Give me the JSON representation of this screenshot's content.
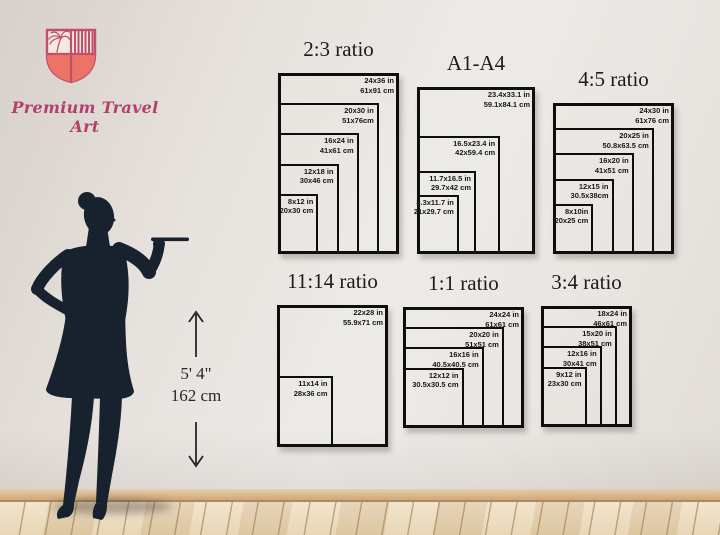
{
  "brand": {
    "name": "Premium Travel Art",
    "logo_icon": "shield-palm-logo-icon",
    "colors": {
      "logo_outline": "#c24f6b",
      "logo_fill": "#ed7366",
      "logo_cream": "#f2eade",
      "text_pink": "#b1406a"
    }
  },
  "figure": {
    "description": "woman-silhouette-scale-reference",
    "height_ft": "5' 4\"",
    "height_cm": "162 cm",
    "silhouette_color": "#18212e"
  },
  "scene": {
    "wall_color": "#e9e5e1",
    "baseboard_color": "#d4af82",
    "floor_color": "#e9d8bb",
    "line_color": "#0e0e0e"
  },
  "chart_data": [
    {
      "type": "nested-size-diagram",
      "title": "2:3 ratio",
      "sizes": [
        {
          "in": "24x36 in",
          "cm": "61x91 cm",
          "w": 24,
          "h": 36
        },
        {
          "in": "20x30 in",
          "cm": "51x76cm",
          "w": 20,
          "h": 30
        },
        {
          "in": "16x24 in",
          "cm": "41x61 cm",
          "w": 16,
          "h": 24
        },
        {
          "in": "12x18 in",
          "cm": "30x46 cm",
          "w": 12,
          "h": 18
        },
        {
          "in": "8x12 in",
          "cm": "20x30 cm",
          "w": 8,
          "h": 12
        }
      ]
    },
    {
      "type": "nested-size-diagram",
      "title": "A1-A4",
      "sizes": [
        {
          "in": "23.4x33.1 in",
          "cm": "59.1x84.1 cm",
          "w": 23.4,
          "h": 33.1
        },
        {
          "in": "16.5x23.4 in",
          "cm": "42x59.4 cm",
          "w": 16.5,
          "h": 23.4
        },
        {
          "in": "11.7x16.5 in",
          "cm": "29.7x42 cm",
          "w": 11.7,
          "h": 16.5
        },
        {
          "in": "8.3x11.7 in",
          "cm": "21x29.7 cm",
          "w": 8.3,
          "h": 11.7
        }
      ]
    },
    {
      "type": "nested-size-diagram",
      "title": "4:5 ratio",
      "sizes": [
        {
          "in": "24x30 in",
          "cm": "61x76 cm",
          "w": 24,
          "h": 30
        },
        {
          "in": "20x25 in",
          "cm": "50.8x63.5 cm",
          "w": 20,
          "h": 25
        },
        {
          "in": "16x20 in",
          "cm": "41x51 cm",
          "w": 16,
          "h": 20
        },
        {
          "in": "12x15 in",
          "cm": "30.5x38cm",
          "w": 12,
          "h": 15
        },
        {
          "in": "8x10in",
          "cm": "20x25 cm",
          "w": 8,
          "h": 10
        }
      ]
    },
    {
      "type": "nested-size-diagram",
      "title": "11:14 ratio",
      "sizes": [
        {
          "in": "22x28 in",
          "cm": "55.9x71 cm",
          "w": 22,
          "h": 28
        },
        {
          "in": "11x14 in",
          "cm": "28x36 cm",
          "w": 11,
          "h": 14
        }
      ]
    },
    {
      "type": "nested-size-diagram",
      "title": "1:1 ratio",
      "sizes": [
        {
          "in": "24x24 in",
          "cm": "61x61 cm",
          "w": 24,
          "h": 24
        },
        {
          "in": "20x20 in",
          "cm": "51x51 cm",
          "w": 20,
          "h": 20
        },
        {
          "in": "16x16 in",
          "cm": "40.5x40.5 cm",
          "w": 16,
          "h": 16
        },
        {
          "in": "12x12 in",
          "cm": "30.5x30.5 cm",
          "w": 12,
          "h": 12
        }
      ]
    },
    {
      "type": "nested-size-diagram",
      "title": "3:4 ratio",
      "sizes": [
        {
          "in": "18x24 in",
          "cm": "46x61 cm",
          "w": 18,
          "h": 24
        },
        {
          "in": "15x20 in",
          "cm": "38x51 cm",
          "w": 15,
          "h": 20
        },
        {
          "in": "12x16 in",
          "cm": "30x41 cm",
          "w": 12,
          "h": 16
        },
        {
          "in": "9x12 in",
          "cm": "23x30 cm",
          "w": 9,
          "h": 12
        }
      ]
    }
  ],
  "icons": {
    "up": "arrow-up-icon",
    "down": "arrow-down-icon"
  }
}
